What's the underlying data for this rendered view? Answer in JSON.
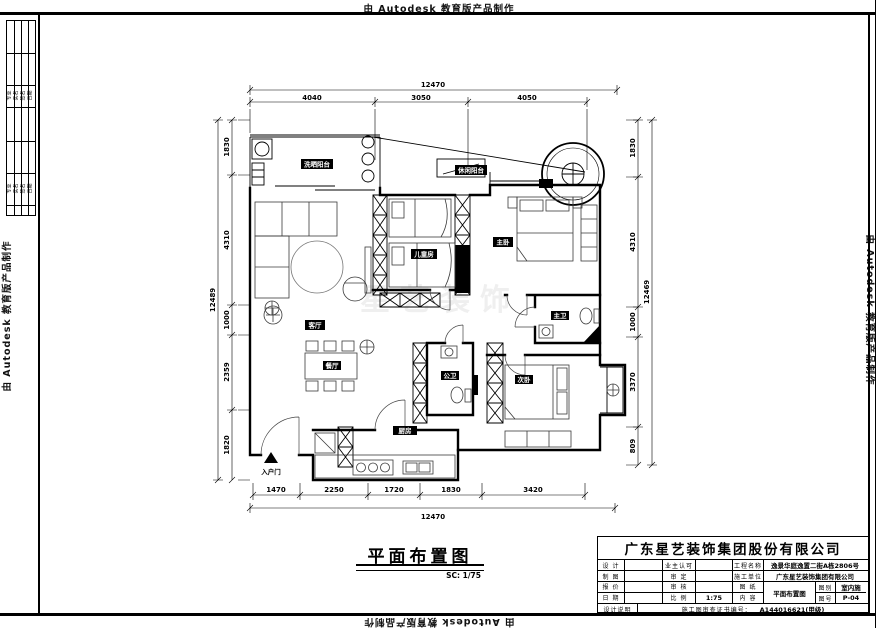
{
  "edge": {
    "autodesk": "由 Autodesk 教育版产品制作"
  },
  "watermark": {
    "text": "星艺装饰"
  },
  "strip": {
    "r1": [
      "专业",
      "实名",
      "签名",
      "日期"
    ],
    "r2": [
      "专业",
      "实名",
      "签名",
      "日期"
    ]
  },
  "plan": {
    "dims": {
      "top": {
        "overall": "12470",
        "segments": [
          "4040",
          "3050",
          "4050"
        ]
      },
      "left": {
        "overall": "12489",
        "segments": [
          "1830",
          "4310",
          "1000",
          "2359",
          "1820"
        ]
      },
      "right": {
        "overall": "12469",
        "segments": [
          "1830",
          "4310",
          "1000",
          "3370",
          "809"
        ]
      },
      "bottom": {
        "overall": "12470",
        "segments": [
          "1470",
          "2250",
          "1720",
          "1830",
          "3420"
        ]
      }
    },
    "rooms": {
      "balcony_wash": "洗晒阳台",
      "balcony_leisure": "休闲阳台",
      "kids": "儿童房",
      "master": "主卧",
      "living": "客厅",
      "dining": "餐厅",
      "kitchen": "厨房",
      "master_bath": "主卫",
      "guest_bath": "公卫",
      "second": "次卧",
      "entry": "入户门"
    }
  },
  "title": {
    "text": "平面布置图",
    "scale": "SC: 1/75"
  },
  "tb": {
    "company": "广东星艺装饰集团股份有限公司",
    "r1": {
      "l1": "设 计",
      "l2": "业主认可"
    },
    "r2": {
      "l1": "制 图",
      "l2": "审 定"
    },
    "r3": {
      "l1": "报 价",
      "l2": "审 核"
    },
    "r4": {
      "l1": "日 期",
      "l2": "比 例",
      "v2": "1:75"
    },
    "project_label": "工程名称",
    "project_value": "逸景华庭逸置二街A栋2806号",
    "builder_label": "施工单位",
    "builder_value": "广东星艺装饰集团有限公司",
    "sheet_l1": "图 纸",
    "sheet_l2": "内 容",
    "sheet_value": "平面布置图",
    "cat_label": "图别",
    "cat_value": "室内施",
    "no_label": "图号",
    "no_value": "P-04",
    "note": "设计说明",
    "cert_label": "施工图审查证书编号：",
    "cert_value": "A144016621(甲级)"
  }
}
